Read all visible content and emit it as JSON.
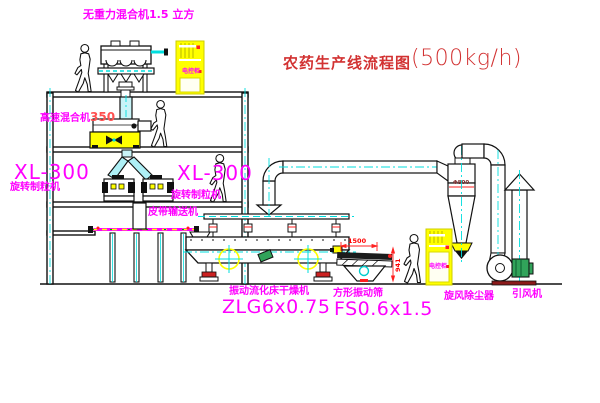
{
  "title": {
    "zh": "农药生产线流程图",
    "capacity": "(500kg/h)"
  },
  "labels": {
    "gravity_mixer": "无重力混合机1.5 立方",
    "high_speed_mixer_name": "高速混合机",
    "high_speed_mixer_num": "350",
    "granulator_left_model": "XL-300",
    "granulator_left_name": "旋转制粒机",
    "granulator_right_model": "XL-300",
    "granulator_right_name": "旋转制粒机",
    "belt_conveyor": "皮带输送机",
    "dryer_name": "振动流化床干燥机",
    "dryer_model": "ZLG6x0.75",
    "sieve_name": "方形振动筛",
    "sieve_model": "FS0.6x1.5",
    "cyclone": "旋风除尘器",
    "fan": "引风机",
    "cabinet_top": "电控柜",
    "cabinet_right": "电控柜"
  },
  "dimensions": {
    "sieve_width": "1500",
    "sieve_height": "941",
    "cyclone_diameter": "Φ800"
  },
  "colors": {
    "label_magenta": "#ff00ff",
    "title_red": "#d23232",
    "equipment_yellow": "#ffff00",
    "centerline_cyan": "#00dede",
    "dimension_red": "#ff0000",
    "motor_green": "#31a35a"
  }
}
